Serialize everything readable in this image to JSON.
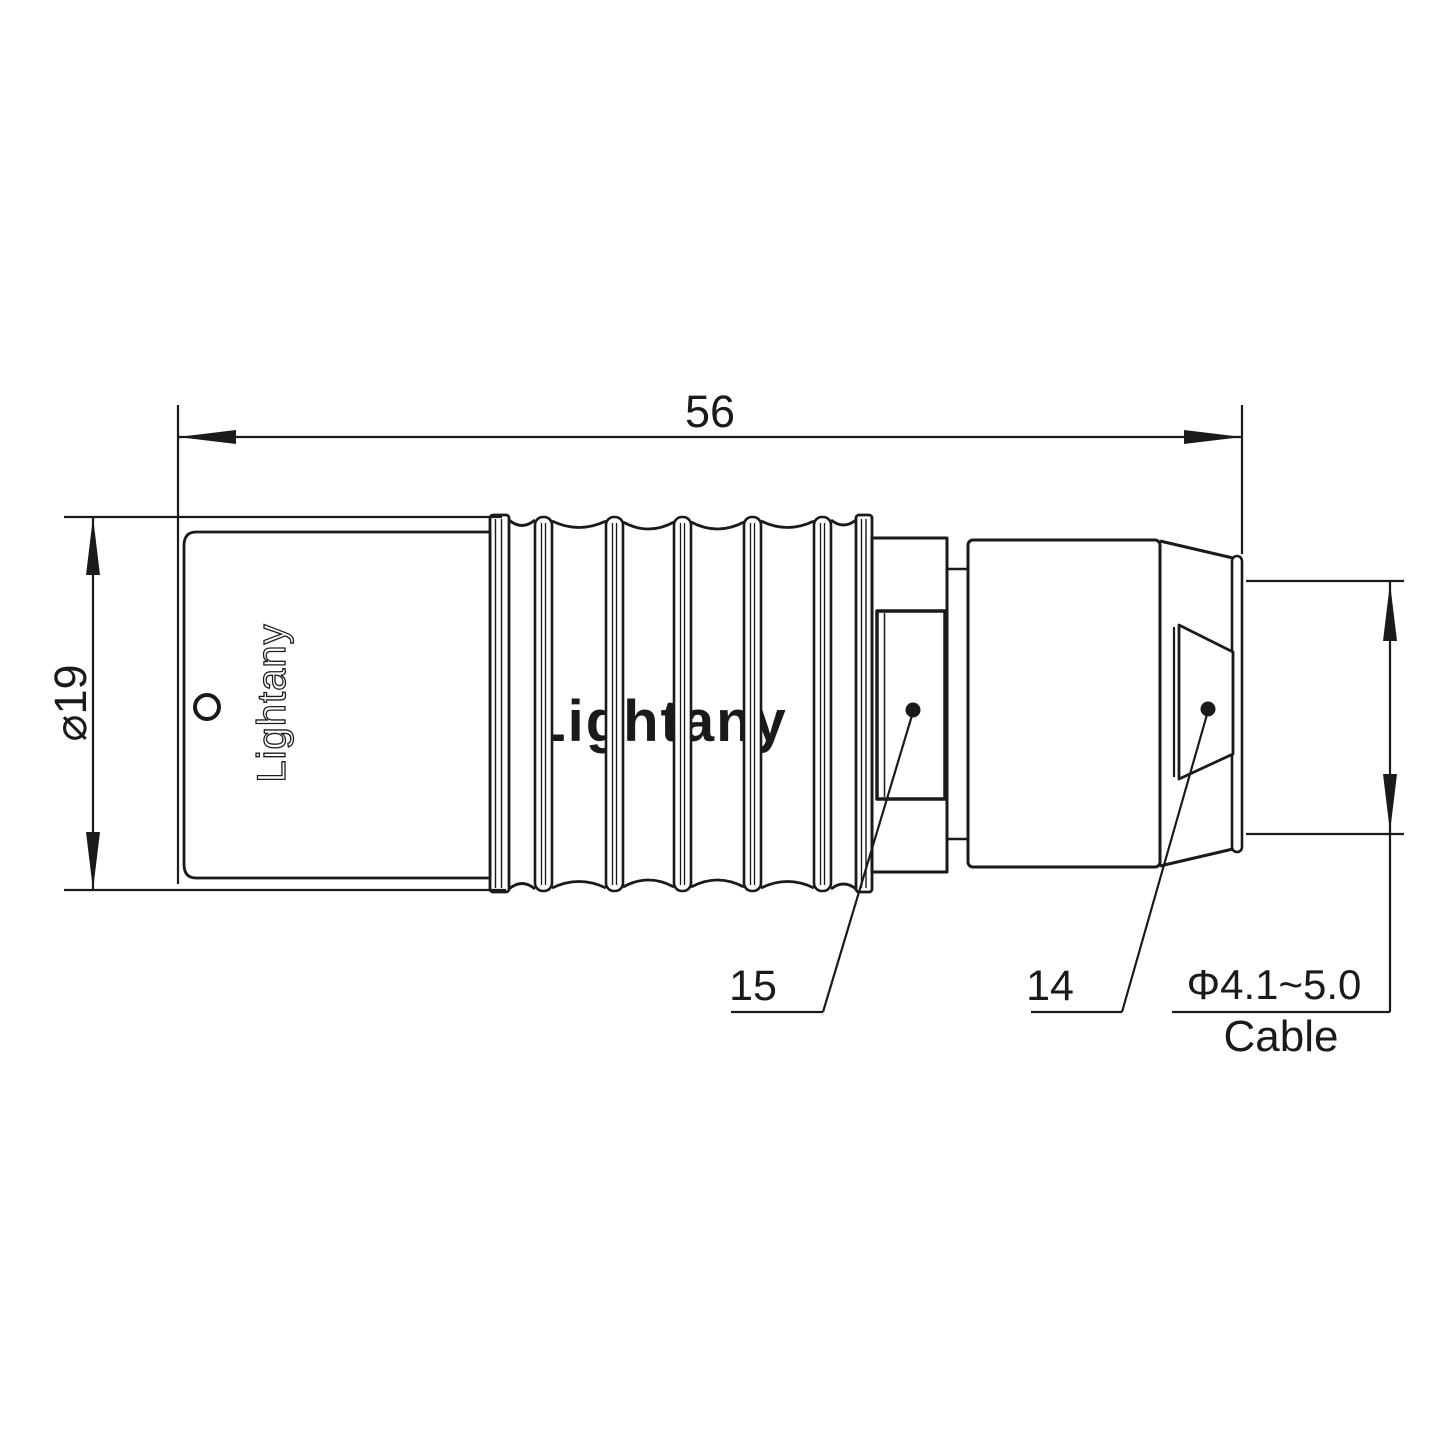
{
  "drawing": {
    "watermark_text": "Lightany",
    "engraving_text": "Lightany",
    "dimensions": {
      "overall_length": "56",
      "outer_diameter": "⌀19",
      "cable_range": "Φ4.1~5.0",
      "cable_word": "Cable"
    },
    "part_labels": {
      "crimp_sleeve": "15",
      "collet_nut": "14"
    },
    "colors": {
      "line": "#1a1a1a",
      "watermark": "#f8cdcd",
      "background": "#ffffff"
    }
  }
}
